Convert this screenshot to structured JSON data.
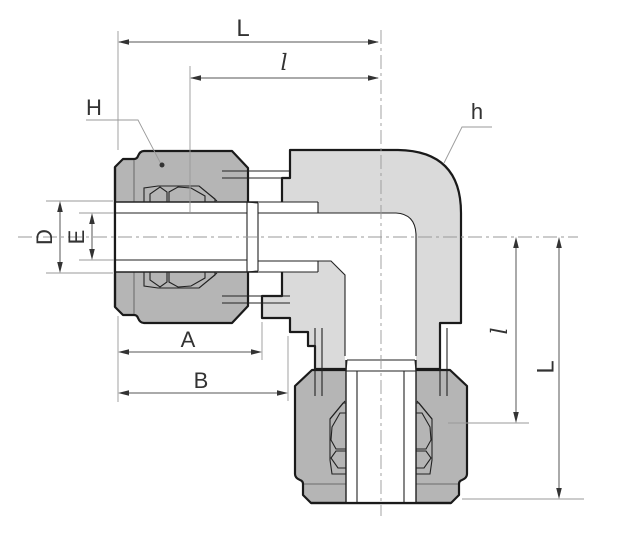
{
  "diagram": {
    "labels": {
      "length_top": "L",
      "port_depth_top": "l",
      "nut_hex": "H",
      "body_hex": "h",
      "tube_od": "D",
      "tube_id": "E",
      "dim_a": "A",
      "dim_b": "B",
      "port_depth_right": "l",
      "length_right": "L"
    },
    "colors": {
      "outline": "#1a1a1a",
      "nut_fill": "#b5b5b5",
      "body_fill": "#dadada",
      "bore_fill": "#ffffff",
      "dim_line": "#555555",
      "ext_line": "#999999",
      "label_text": "#333333",
      "background": "#ffffff"
    }
  }
}
